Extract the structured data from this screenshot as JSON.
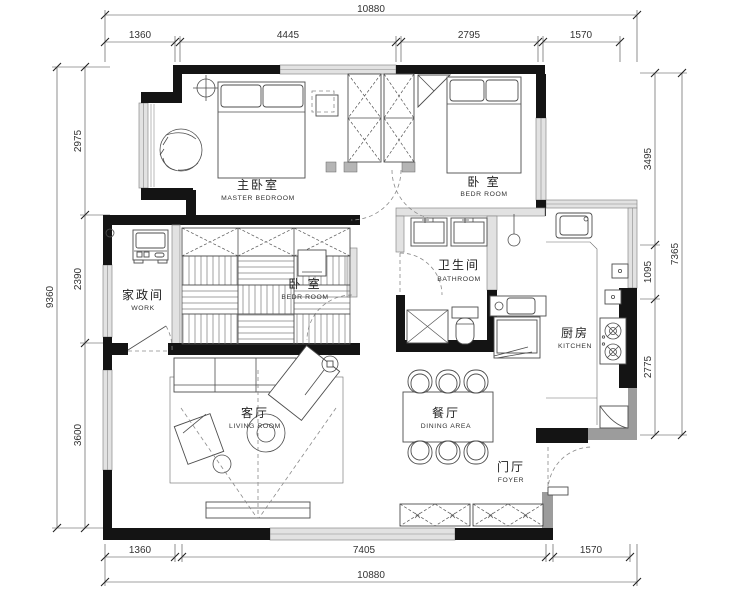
{
  "title": "apartment-floor-plan",
  "dimensions": {
    "top": {
      "overall": "10880",
      "segments": [
        "1360",
        "4445",
        "2795",
        "1570"
      ]
    },
    "bottom": {
      "overall": "10880",
      "segments": [
        "1360",
        "7405",
        "1570"
      ]
    },
    "left": {
      "overall": "9360",
      "segments": [
        "2975",
        "2390",
        "3600"
      ]
    },
    "right": {
      "overall": "7365",
      "segments": [
        "3495",
        "1095",
        "2775"
      ]
    }
  },
  "rooms": {
    "master_bedroom": {
      "zh": "主卧室",
      "en": "MASTER BEDROOM"
    },
    "bedroom_top": {
      "zh": "卧 室",
      "en": "BEDR ROOM"
    },
    "bedroom_mid": {
      "zh": "卧 室",
      "en": "BEDR ROOM"
    },
    "work": {
      "zh": "家政间",
      "en": "WORK"
    },
    "bathroom": {
      "zh": "卫生间",
      "en": "BATHROOM"
    },
    "kitchen": {
      "zh": "厨房",
      "en": "KITCHEN"
    },
    "living": {
      "zh": "客厅",
      "en": "LIVING ROOM"
    },
    "dining": {
      "zh": "餐厅",
      "en": "DINING AREA"
    },
    "foyer": {
      "zh": "门厅",
      "en": "FOYER"
    }
  },
  "colors": {
    "wall": "#141414",
    "window_fill": "#e2e2e2",
    "grey_wall": "#9c9c9c",
    "line": "#4d4d4d",
    "dim": "#333333",
    "background": "#ffffff"
  }
}
